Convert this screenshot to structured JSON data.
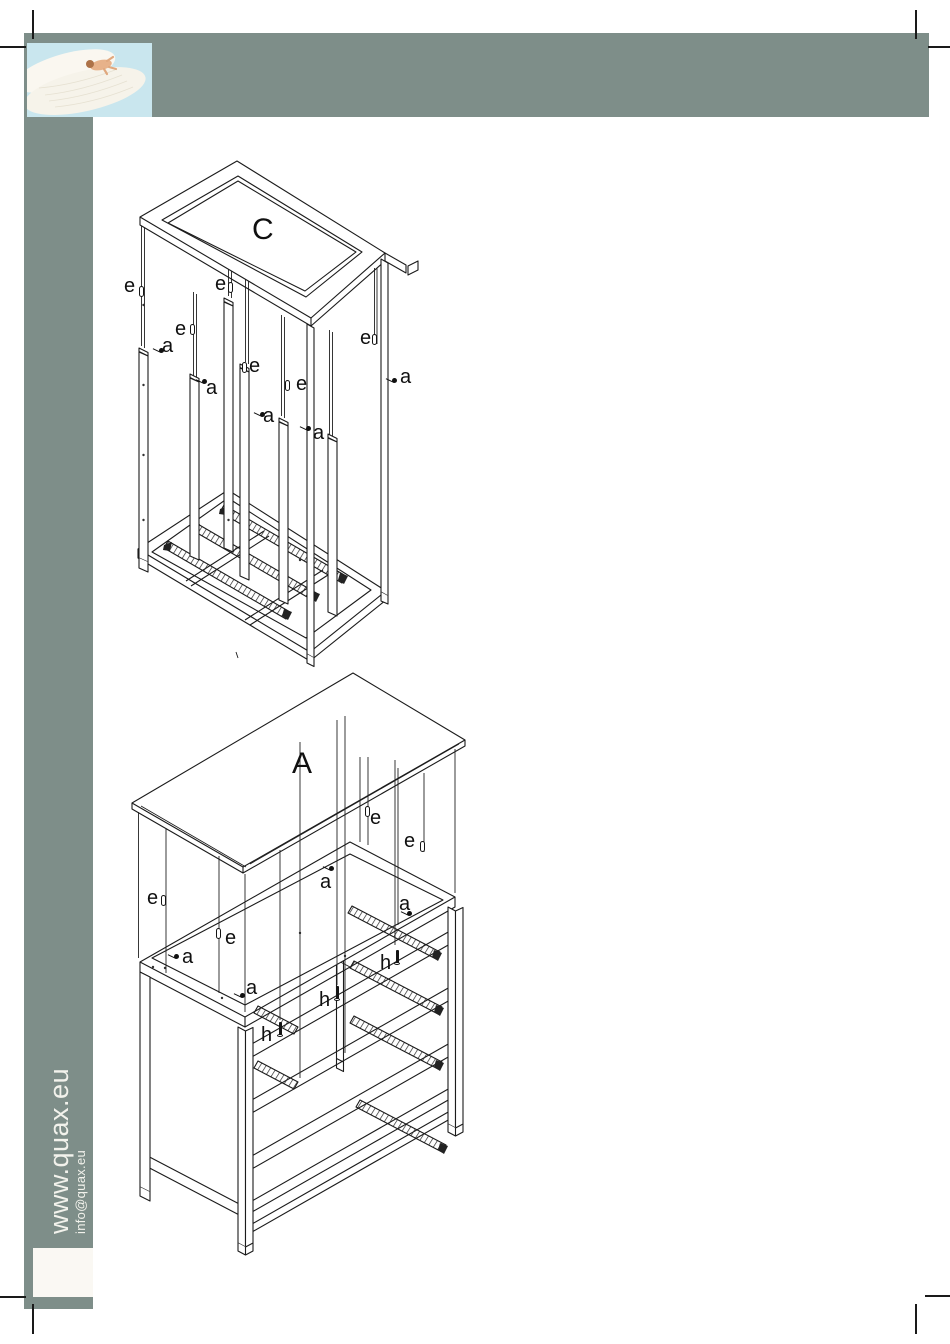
{
  "brand": {
    "website": "www.quax.eu",
    "email": "info@quax.eu"
  },
  "colors": {
    "band": "#7e8e89",
    "band_text": "#f2f2ec",
    "line": "#1b1b1b",
    "inset_box": "#faf8f3",
    "photo_sky": "#c9e6ee",
    "photo_feather": "#f6f3ea"
  },
  "photo": {
    "description": "baby lying on a white feather against a light blue sky"
  },
  "drawings": {
    "c": {
      "title": "C",
      "labels": [
        {
          "text": "e",
          "x": 124,
          "y": 276,
          "glyph": "dowel",
          "gx": 139,
          "gy": 286
        },
        {
          "text": "e",
          "x": 215,
          "y": 274,
          "glyph": "dowel",
          "gx": 228,
          "gy": 282
        },
        {
          "text": "e",
          "x": 175,
          "y": 319,
          "glyph": "dowel",
          "gx": 190,
          "gy": 324
        },
        {
          "text": "e",
          "x": 249,
          "y": 356,
          "glyph": "dowel",
          "gx": 242,
          "gy": 362
        },
        {
          "text": "e",
          "x": 296,
          "y": 374,
          "glyph": "dowel",
          "gx": 285,
          "gy": 380
        },
        {
          "text": "e",
          "x": 360,
          "y": 328,
          "glyph": "dowel",
          "gx": 372,
          "gy": 334
        },
        {
          "text": "a",
          "x": 162,
          "y": 336,
          "glyph": "screw",
          "gx": 152,
          "gy": 346
        },
        {
          "text": "a",
          "x": 206,
          "y": 378,
          "glyph": "screw",
          "gx": 195,
          "gy": 377
        },
        {
          "text": "a",
          "x": 263,
          "y": 406,
          "glyph": "screw",
          "gx": 253,
          "gy": 410
        },
        {
          "text": "a",
          "x": 313,
          "y": 423,
          "glyph": "screw",
          "gx": 299,
          "gy": 424
        },
        {
          "text": "a",
          "x": 400,
          "y": 367,
          "glyph": "screw",
          "gx": 385,
          "gy": 376
        }
      ]
    },
    "a": {
      "title": "A",
      "labels": [
        {
          "text": "e",
          "x": 370,
          "y": 808,
          "glyph": "dowel",
          "gx": 365,
          "gy": 806
        },
        {
          "text": "e",
          "x": 404,
          "y": 831,
          "glyph": "dowel",
          "gx": 420,
          "gy": 841
        },
        {
          "text": "e",
          "x": 147,
          "y": 888,
          "glyph": "dowel",
          "gx": 161,
          "gy": 895
        },
        {
          "text": "e",
          "x": 225,
          "y": 928,
          "glyph": "dowel",
          "gx": 216,
          "gy": 928
        },
        {
          "text": "a",
          "x": 320,
          "y": 872,
          "glyph": "screw",
          "gx": 322,
          "gy": 864
        },
        {
          "text": "a",
          "x": 182,
          "y": 947,
          "glyph": "screw",
          "gx": 167,
          "gy": 952
        },
        {
          "text": "a",
          "x": 246,
          "y": 978,
          "glyph": "screw",
          "gx": 233,
          "gy": 991
        },
        {
          "text": "a",
          "x": 399,
          "y": 894,
          "glyph": "screw",
          "gx": 400,
          "gy": 909
        },
        {
          "text": "h",
          "x": 261,
          "y": 1025,
          "glyph": "bolt",
          "gx": 277,
          "gy": 1022
        },
        {
          "text": "h",
          "x": 319,
          "y": 990,
          "glyph": "bolt",
          "gx": 334,
          "gy": 986
        },
        {
          "text": "h",
          "x": 380,
          "y": 953,
          "glyph": "bolt",
          "gx": 394,
          "gy": 950
        }
      ]
    }
  }
}
